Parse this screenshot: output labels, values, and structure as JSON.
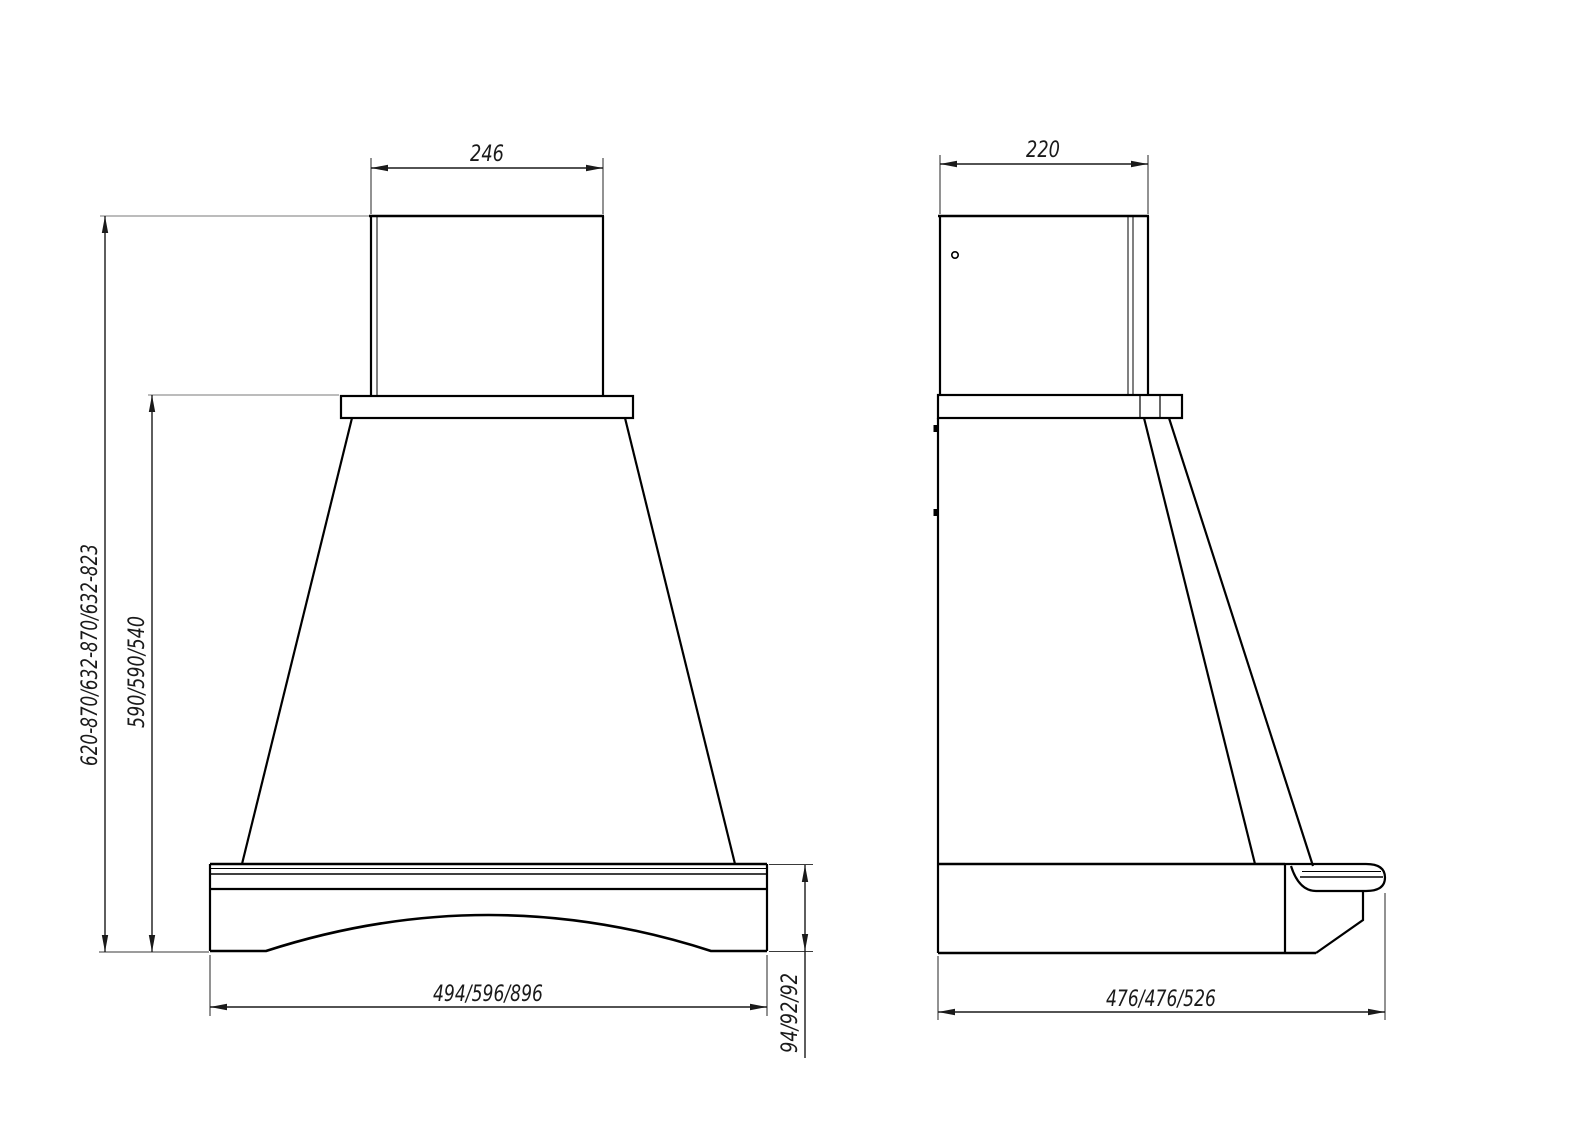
{
  "canvas": {
    "width": 1588,
    "height": 1123,
    "background": "#ffffff"
  },
  "style": {
    "object_line_color": "#000000",
    "dimension_line_color": "#1a1a1a",
    "extension_line_color": "#7a7a7a",
    "text_color": "#1a1a1a"
  },
  "views": {
    "front": {
      "dims": {
        "chimney_width": "246",
        "overall_height": "620-870/632-870/632-823",
        "body_height": "590/590/540",
        "base_width": "494/596/896",
        "base_height": "94/92/92"
      }
    },
    "side": {
      "dims": {
        "chimney_depth": "220",
        "base_depth": "476/476/526"
      }
    }
  }
}
